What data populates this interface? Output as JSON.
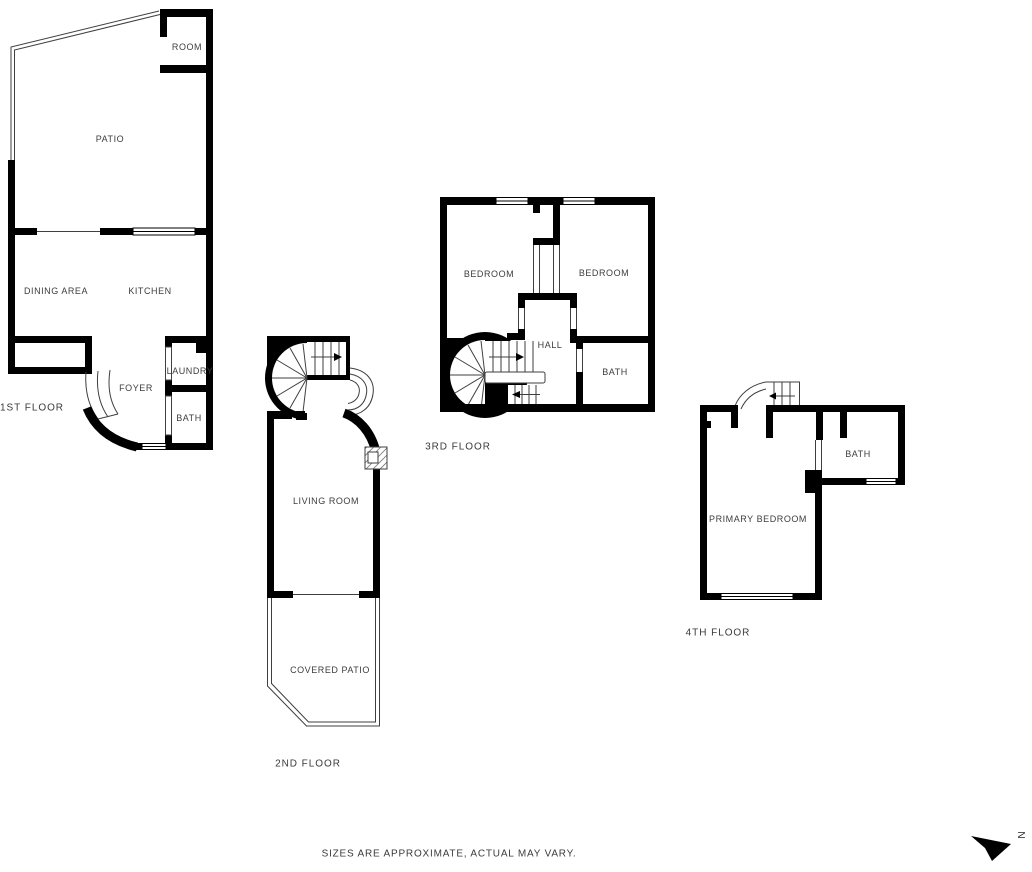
{
  "page": {
    "background": "#ffffff",
    "wall_color": "#000000",
    "line_color": "#3f3f3f",
    "text_color": "#3d3d3d"
  },
  "floors": {
    "f1": {
      "label": "1ST FLOOR",
      "rooms": {
        "room": "ROOM",
        "patio": "PATIO",
        "dining": "DINING AREA",
        "kitchen": "KITCHEN",
        "laundry": "LAUNDRY",
        "foyer": "FOYER",
        "bath": "BATH"
      }
    },
    "f2": {
      "label": "2ND FLOOR",
      "rooms": {
        "living": "LIVING ROOM",
        "covered_patio": "COVERED PATIO"
      }
    },
    "f3": {
      "label": "3RD FLOOR",
      "rooms": {
        "bedroom_left": "BEDROOM",
        "bedroom_right": "BEDROOM",
        "hall": "HALL",
        "bath": "BATH"
      }
    },
    "f4": {
      "label": "4TH FLOOR",
      "rooms": {
        "bath": "BATH",
        "primary_bedroom": "PRIMARY BEDROOM"
      }
    }
  },
  "footer": {
    "disclaimer": "SIZES ARE APPROXIMATE, ACTUAL MAY VARY."
  },
  "compass": {
    "letter": "N"
  }
}
